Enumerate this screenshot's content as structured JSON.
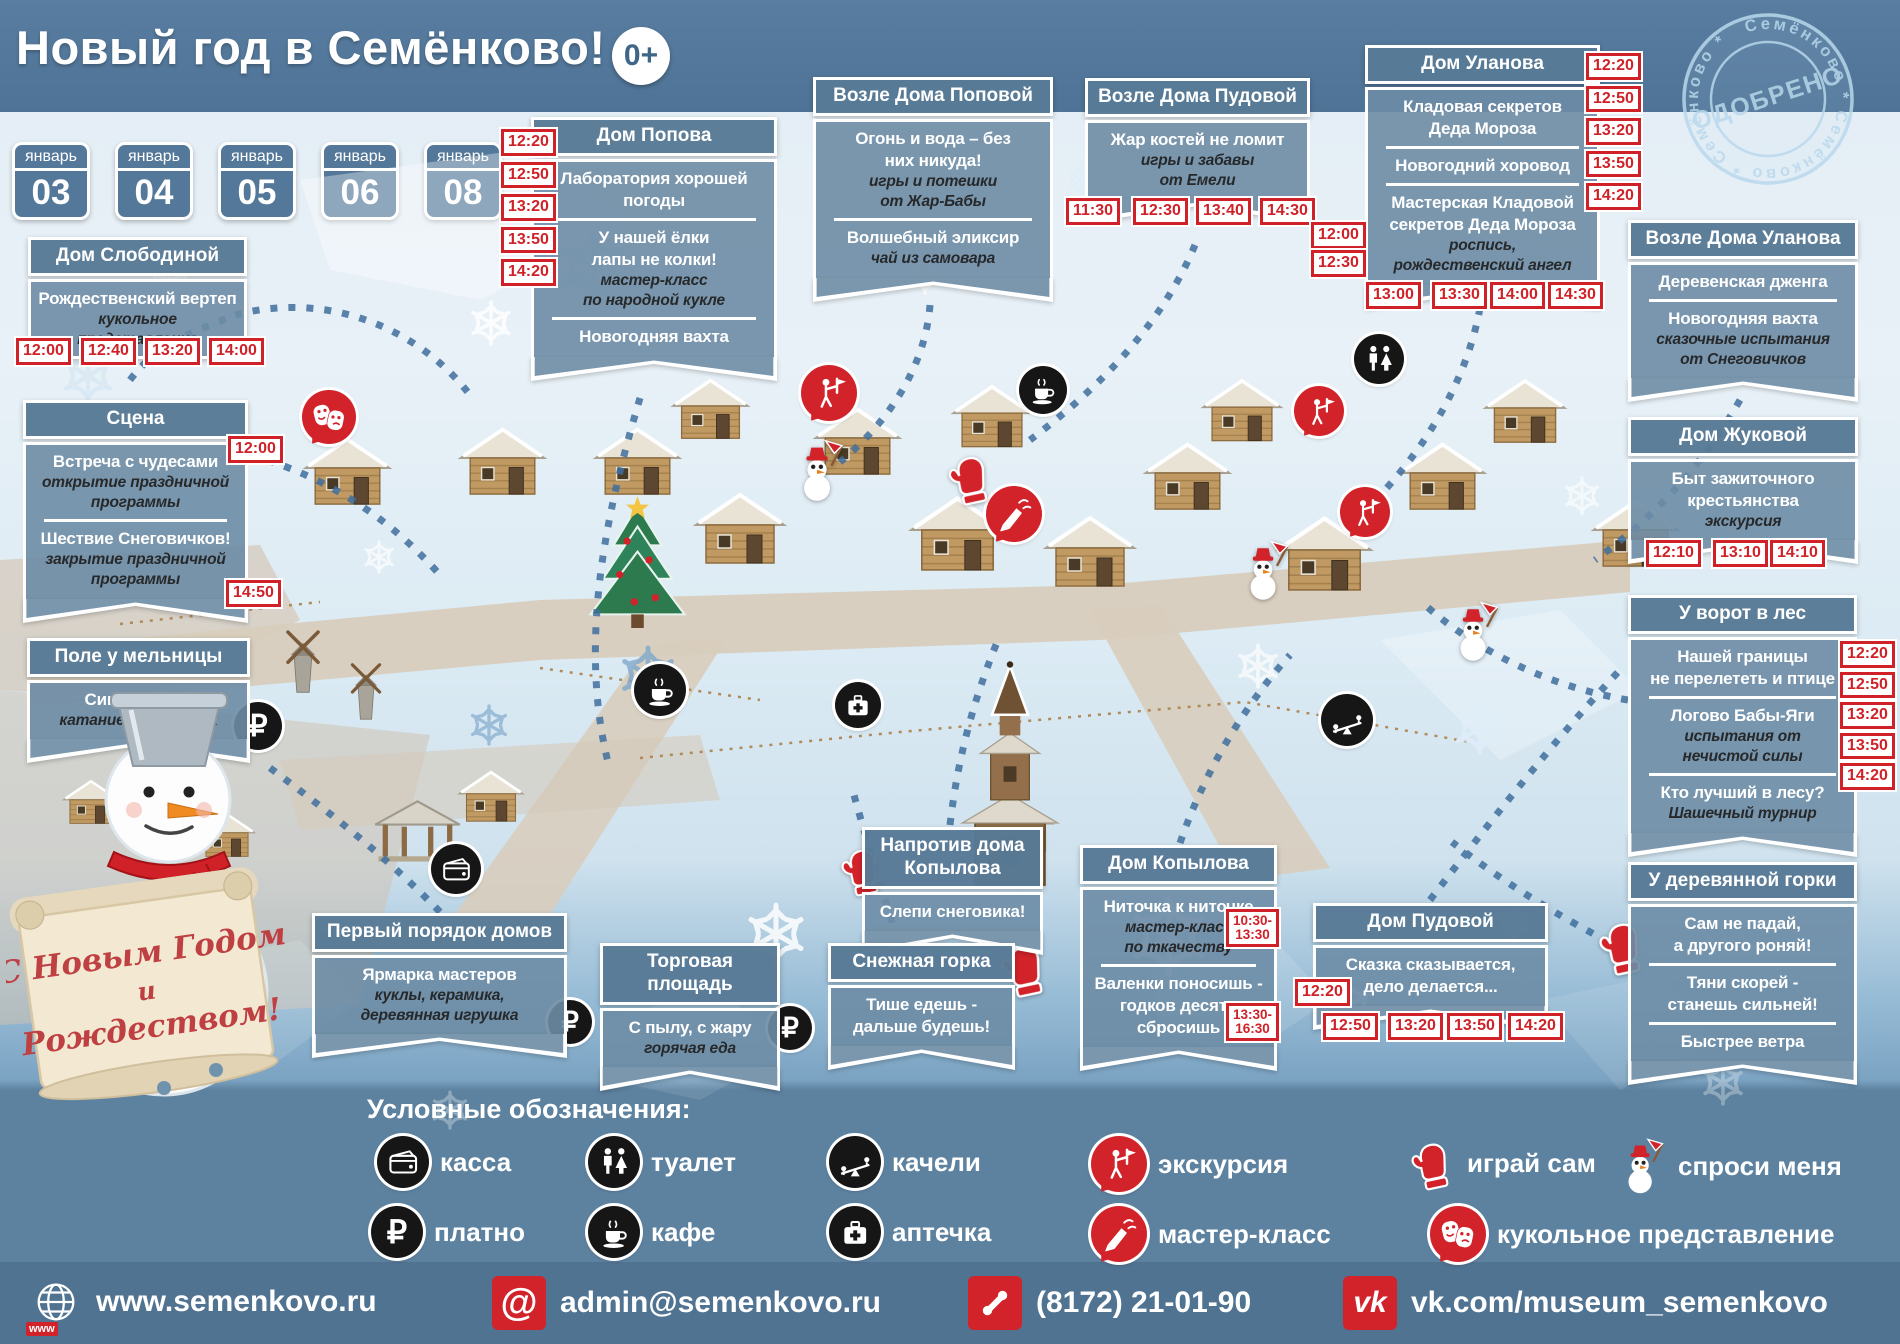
{
  "header": {
    "title": "Новый год в Семёнково!",
    "age_badge": "0+"
  },
  "stamp": {
    "center_text": "ОДОБРЕНО",
    "ring_text": "Семёнково * Семёнково * Семёнково *"
  },
  "calendar": {
    "month": "январь",
    "days": [
      "03",
      "04",
      "05",
      "06",
      "08"
    ]
  },
  "colors": {
    "accent_red": "#d2232a",
    "panel_blue": "#5d82a0",
    "banner_blue": "#6d8ca5"
  },
  "banners": [
    {
      "id": "dom-slobodinoy",
      "title_lines": [
        "Дом Слободиной"
      ],
      "sections": [
        {
          "lines": [
            {
              "text": "Рождественский вертеп",
              "style": "bold"
            },
            {
              "text": "кукольное",
              "style": "italic"
            },
            {
              "text": "представление",
              "style": "italic"
            }
          ]
        }
      ],
      "times_bottom": [
        "12:00",
        "12:40",
        "13:20",
        "14:00"
      ]
    },
    {
      "id": "scena",
      "title_lines": [
        "Сцена"
      ],
      "sections": [
        {
          "lines": [
            {
              "text": "Встреча с чудесами",
              "style": "bold"
            },
            {
              "text": "открытие праздничной",
              "style": "italic"
            },
            {
              "text": "программы",
              "style": "italic"
            }
          ],
          "time": "12:00"
        },
        {
          "lines": [
            {
              "text": "Шествие Снеговичков!",
              "style": "bold"
            },
            {
              "text": "закрытие праздничной",
              "style": "italic"
            },
            {
              "text": "программы",
              "style": "italic"
            }
          ],
          "time": "14:50"
        }
      ]
    },
    {
      "id": "pole-u-melnicy",
      "title_lines": [
        "Поле у мельницы"
      ],
      "sections": [
        {
          "lines": [
            {
              "text": "Сивка-бурка!",
              "style": "bold"
            },
            {
              "text": "катание на лошадях",
              "style": "italic"
            }
          ]
        }
      ]
    },
    {
      "id": "dom-popova",
      "title_lines": [
        "Дом Попова"
      ],
      "sections": [
        {
          "lines": [
            {
              "text": "Лаборатория хорошей",
              "style": "bold"
            },
            {
              "text": "погоды",
              "style": "bold"
            }
          ]
        },
        {
          "lines": [
            {
              "text": "У нашей ёлки",
              "style": "bold"
            },
            {
              "text": "лапы не колки!",
              "style": "bold"
            },
            {
              "text": "мастер-класс",
              "style": "italic"
            },
            {
              "text": "по народной кукле",
              "style": "italic"
            }
          ]
        },
        {
          "lines": [
            {
              "text": "Новогодняя вахта",
              "style": "bold"
            }
          ]
        }
      ],
      "times_left": [
        "12:20",
        "12:50",
        "13:20",
        "13:50",
        "14:20"
      ]
    },
    {
      "id": "vozle-doma-popovoy",
      "title_lines": [
        "Возле Дома Поповой"
      ],
      "sections": [
        {
          "lines": [
            {
              "text": "Огонь и вода – без",
              "style": "bold"
            },
            {
              "text": "них никуда!",
              "style": "bold"
            },
            {
              "text": "игры и потешки",
              "style": "italic"
            },
            {
              "text": "от Жар-Бабы",
              "style": "italic"
            }
          ]
        },
        {
          "lines": [
            {
              "text": "Волшебный эликсир",
              "style": "bold"
            },
            {
              "text": "чай из самовара",
              "style": "italic"
            }
          ]
        }
      ]
    },
    {
      "id": "vozle-doma-pudovoy",
      "title_lines": [
        "Возле Дома Пудовой"
      ],
      "sections": [
        {
          "lines": [
            {
              "text": "Жар костей не ломит",
              "style": "bold"
            },
            {
              "text": "игры и забавы",
              "style": "italic"
            },
            {
              "text": "от Емели",
              "style": "italic"
            }
          ]
        }
      ],
      "times_bottom": [
        "11:30",
        "12:30",
        "13:40",
        "14:30"
      ]
    },
    {
      "id": "dom-ulanova",
      "title_lines": [
        "Дом Уланова"
      ],
      "sections": [
        {
          "lines": [
            {
              "text": "Кладовая секретов",
              "style": "bold"
            },
            {
              "text": "Деда Мороза",
              "style": "bold"
            }
          ]
        },
        {
          "lines": [
            {
              "text": "Новогодний хоровод",
              "style": "bold"
            }
          ]
        },
        {
          "lines": [
            {
              "text": "Мастерская Кладовой",
              "style": "bold"
            },
            {
              "text": "секретов Деда Мороза",
              "style": "bold"
            },
            {
              "text": "роспись,",
              "style": "italic"
            },
            {
              "text": "рождественский ангел",
              "style": "italic"
            }
          ]
        }
      ],
      "times_right": [
        "12:20",
        "12:50",
        "13:20",
        "13:50",
        "14:20"
      ],
      "times_left": [
        "12:00",
        "12:30"
      ],
      "times_bottom": [
        "13:00",
        "13:30",
        "14:00",
        "14:30"
      ]
    },
    {
      "id": "vozle-doma-ulanova",
      "title_lines": [
        "Возле Дома Уланова"
      ],
      "sections": [
        {
          "lines": [
            {
              "text": "Деревенская дженга",
              "style": "bold"
            }
          ]
        },
        {
          "lines": [
            {
              "text": "Новогодняя вахта",
              "style": "bold"
            },
            {
              "text": "сказочные испытания",
              "style": "italic"
            },
            {
              "text": "от Снеговичков",
              "style": "italic"
            }
          ]
        }
      ]
    },
    {
      "id": "dom-zhukovoy",
      "title_lines": [
        "Дом Жуковой"
      ],
      "sections": [
        {
          "lines": [
            {
              "text": "Быт зажиточного",
              "style": "bold"
            },
            {
              "text": "крестьянства",
              "style": "bold"
            },
            {
              "text": "экскурсия",
              "style": "italic"
            }
          ]
        }
      ],
      "times_bottom": [
        "12:10",
        "13:10",
        "14:10"
      ]
    },
    {
      "id": "u-vorot-v-les",
      "title_lines": [
        "У ворот в лес"
      ],
      "sections": [
        {
          "lines": [
            {
              "text": "Нашей границы",
              "style": "bold"
            },
            {
              "text": "не перелететь и птице",
              "style": "bold"
            }
          ]
        },
        {
          "lines": [
            {
              "text": "Логово Бабы-Яги",
              "style": "bold"
            },
            {
              "text": "испытания от",
              "style": "italic"
            },
            {
              "text": "нечистой силы",
              "style": "italic"
            }
          ]
        },
        {
          "lines": [
            {
              "text": "Кто лучший в лесу?",
              "style": "bold"
            },
            {
              "text": "Шашечный турнир",
              "style": "italic"
            }
          ]
        }
      ],
      "times_right": [
        "12:20",
        "12:50",
        "13:20",
        "13:50",
        "14:20"
      ]
    },
    {
      "id": "u-derevyannoy-gorki",
      "title_lines": [
        "У деревянной горки"
      ],
      "sections": [
        {
          "lines": [
            {
              "text": "Сам не падай,",
              "style": "bold"
            },
            {
              "text": "а другого роняй!",
              "style": "bold"
            }
          ]
        },
        {
          "lines": [
            {
              "text": "Тяни скорей -",
              "style": "bold"
            },
            {
              "text": "станешь сильней!",
              "style": "bold"
            }
          ]
        },
        {
          "lines": [
            {
              "text": "Быстрее ветра",
              "style": "bold"
            }
          ]
        }
      ]
    },
    {
      "id": "naprotiv-doma-kopylova",
      "title_lines": [
        "Напротив дома",
        "Копылова"
      ],
      "sections": [
        {
          "lines": [
            {
              "text": "Слепи снеговика!",
              "style": "bold"
            }
          ]
        }
      ]
    },
    {
      "id": "dom-kopylova",
      "title_lines": [
        "Дом Копылова"
      ],
      "sections": [
        {
          "lines": [
            {
              "text": "Ниточка к ниточке",
              "style": "bold"
            },
            {
              "text": "мастер-класс",
              "style": "italic"
            },
            {
              "text": "по ткачеству",
              "style": "italic"
            }
          ],
          "time": "10:30-\n13:30"
        },
        {
          "lines": [
            {
              "text": "Валенки поносишь -",
              "style": "bold"
            },
            {
              "text": "годков десять",
              "style": "bold"
            },
            {
              "text": "сбросишь",
              "style": "bold"
            }
          ],
          "time": "13:30-\n16:30"
        }
      ]
    },
    {
      "id": "dom-pudovoy",
      "title_lines": [
        "Дом Пудовой"
      ],
      "sections": [
        {
          "lines": [
            {
              "text": "Сказка сказывается,",
              "style": "bold"
            },
            {
              "text": "дело делается...",
              "style": "bold"
            }
          ],
          "time": "12:20"
        }
      ],
      "times_bottom": [
        "12:50",
        "13:20",
        "13:50",
        "14:20"
      ]
    },
    {
      "id": "perviy-poryadok-domov",
      "title_lines": [
        "Первый порядок домов"
      ],
      "sections": [
        {
          "lines": [
            {
              "text": "Ярмарка мастеров",
              "style": "bold"
            },
            {
              "text": "куклы, керамика,",
              "style": "italic"
            },
            {
              "text": "деревянная игрушка",
              "style": "italic"
            }
          ]
        }
      ]
    },
    {
      "id": "torgovaya-ploschad",
      "title_lines": [
        "Торговая",
        "площадь"
      ],
      "sections": [
        {
          "lines": [
            {
              "text": "С пылу, с жару",
              "style": "bold"
            },
            {
              "text": "горячая еда",
              "style": "italic"
            }
          ]
        }
      ]
    },
    {
      "id": "snezhnaya-gorka",
      "title_lines": [
        "Снежная горка"
      ],
      "sections": [
        {
          "lines": [
            {
              "text": "Тише едешь -",
              "style": "bold"
            },
            {
              "text": "дальше будешь!",
              "style": "bold"
            }
          ]
        }
      ]
    }
  ],
  "map_icons": [
    {
      "name": "puppet-show-icon",
      "type": "masks"
    },
    {
      "name": "excursion-icon",
      "type": "excursion"
    },
    {
      "name": "cafe-icon",
      "type": "coffee"
    },
    {
      "name": "toilet-icon",
      "type": "wc"
    },
    {
      "name": "excursion-icon",
      "type": "excursion"
    },
    {
      "name": "master-class-icon",
      "type": "masterclass"
    },
    {
      "name": "excursion-icon",
      "type": "excursion"
    },
    {
      "name": "play-yourself-mitten-icon",
      "type": "mitten"
    },
    {
      "name": "ask-me-snowman-icon",
      "type": "snowman"
    },
    {
      "name": "ask-me-snowman-icon",
      "type": "snowman"
    },
    {
      "name": "ask-me-snowman-icon",
      "type": "snowman"
    },
    {
      "name": "cafe-icon",
      "type": "coffee"
    },
    {
      "name": "first-aid-icon",
      "type": "firstaid"
    },
    {
      "name": "paid-icon",
      "type": "ruble"
    },
    {
      "name": "toilet-icon",
      "type": "wc"
    },
    {
      "name": "cash-desk-icon",
      "type": "wallet"
    },
    {
      "name": "seesaw-icon",
      "type": "seesaw"
    },
    {
      "name": "paid-icon",
      "type": "ruble"
    },
    {
      "name": "paid-icon",
      "type": "ruble"
    },
    {
      "name": "play-yourself-mitten-icon",
      "type": "mitten"
    },
    {
      "name": "play-yourself-mitten-icon",
      "type": "mitten"
    },
    {
      "name": "play-yourself-mitten-icon",
      "type": "mitten"
    }
  ],
  "mascot": {
    "scroll_lines": [
      "С Новым Годом",
      "и",
      "Рождеством!"
    ]
  },
  "legend": {
    "title": "Условные обозначения:",
    "rows": [
      [
        {
          "icon": "cash-desk-icon",
          "type": "wallet",
          "label": "касса"
        },
        {
          "icon": "toilet-icon",
          "type": "wc",
          "label": "туалет"
        },
        {
          "icon": "seesaw-icon",
          "type": "seesaw",
          "label": "качели"
        },
        {
          "icon": "excursion-icon",
          "type": "excursion",
          "label": "экскурсия"
        },
        {
          "icon": "mitten-icon",
          "type": "mitten",
          "label": "играй сам"
        },
        {
          "icon": "snowman-icon",
          "type": "snowman",
          "label": "спроси меня"
        }
      ],
      [
        {
          "icon": "paid-icon",
          "type": "ruble",
          "label": "платно"
        },
        {
          "icon": "cafe-icon",
          "type": "coffee",
          "label": "кафе"
        },
        {
          "icon": "first-aid-icon",
          "type": "firstaid",
          "label": "аптечка"
        },
        {
          "icon": "master-class-icon",
          "type": "masterclass",
          "label": "мастер-класс"
        },
        {
          "icon": "puppet-show-icon",
          "type": "masks",
          "label": "кукольное представление"
        }
      ]
    ]
  },
  "contacts": [
    {
      "icon": "globe-icon",
      "text": "www.semenkovo.ru"
    },
    {
      "icon": "at-icon",
      "text": "admin@semenkovo.ru"
    },
    {
      "icon": "phone-icon",
      "text": "(8172) 21-01-90"
    },
    {
      "icon": "vk-icon",
      "text": "vk.com/museum_semenkovo"
    }
  ]
}
